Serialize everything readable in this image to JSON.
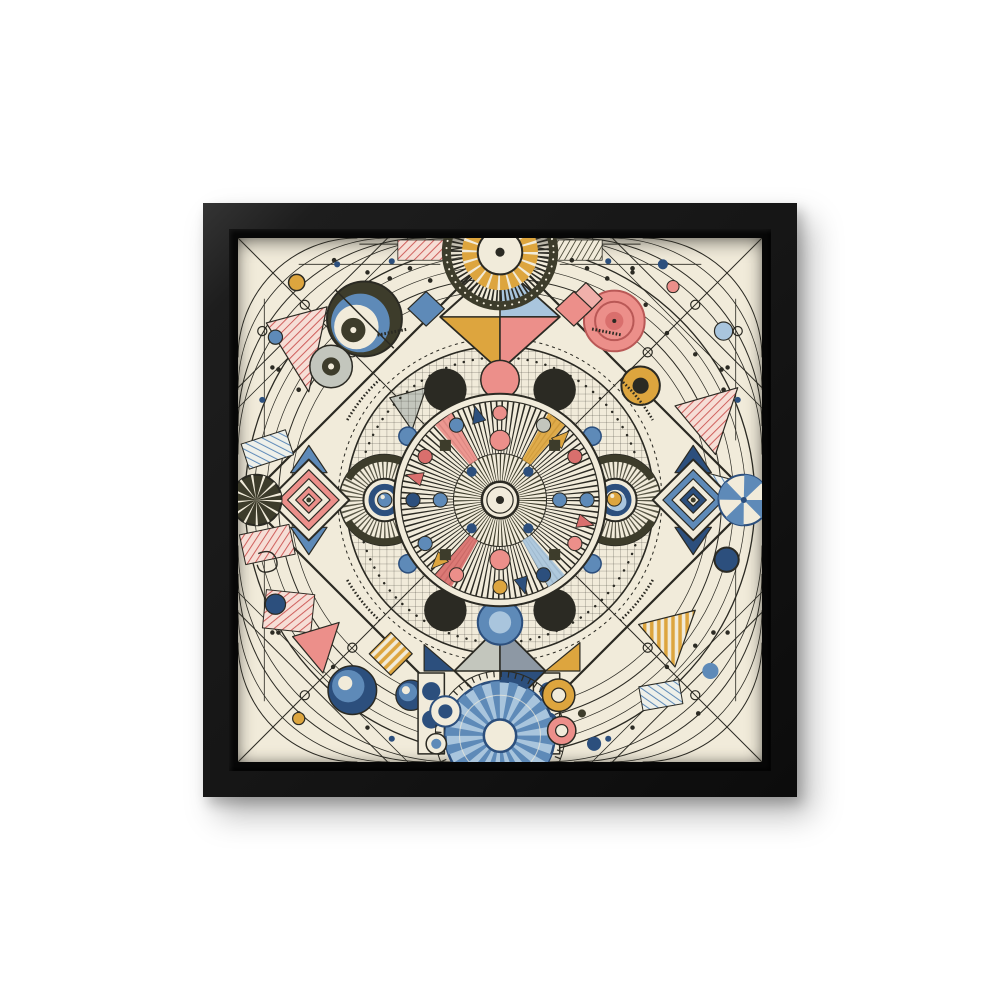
{
  "scene": {
    "type": "product photo",
    "description": "Black square float frame hanging on a plain white wall, holding a canvas print of an intricate abstract geometric mandala in a vintage modernist style",
    "wall_color": "#ffffff"
  },
  "frame": {
    "style": "black float frame",
    "face_color": "#151515",
    "gap_color": "#070707",
    "shadow": "soft drop shadow toward lower right"
  },
  "artwork": {
    "style": "abstract geometric mandala line art",
    "canvas_color": "#f1ebda",
    "line_color": "#2b2a23",
    "palette": {
      "pink": "#ec8f8a",
      "pinklight": "#f0b0ab",
      "red": "#d96f6d",
      "blue": "#5e8ab8",
      "lblue": "#a9c5dd",
      "navy": "#2c4f7d",
      "gold": "#dda53e",
      "olive": "#3d3c2b",
      "gray": "#c3c6bd",
      "slate": "#8d98a4"
    },
    "motifs": [
      "central sunburst disc with radial spokes and ring of colored dots and triangles",
      "scalloped ring with black half-moon circles, pink circle above, blue circle below",
      "graph-paper grid annulus around the central disc",
      "gold and black fan sunburst at top center over a four-color diamond",
      "blue spoked wheel at bottom center over a gray diamond",
      "radial-hatched eye motifs left and right with navy rings (blue and gold pupils)",
      "concentric pink diamond on the left, concentric blue diamond on the right",
      "pinwheel circles at far left (olive) and far right (blue)",
      "crescent moon eye circle and gray target in top-left corner",
      "pink target circle and gold circle in top-right corner",
      "navy swirl circles and dotted panels in bottom corners",
      "hatched red, blue and gold patches, concentric corner arcs with bead dots"
    ]
  }
}
